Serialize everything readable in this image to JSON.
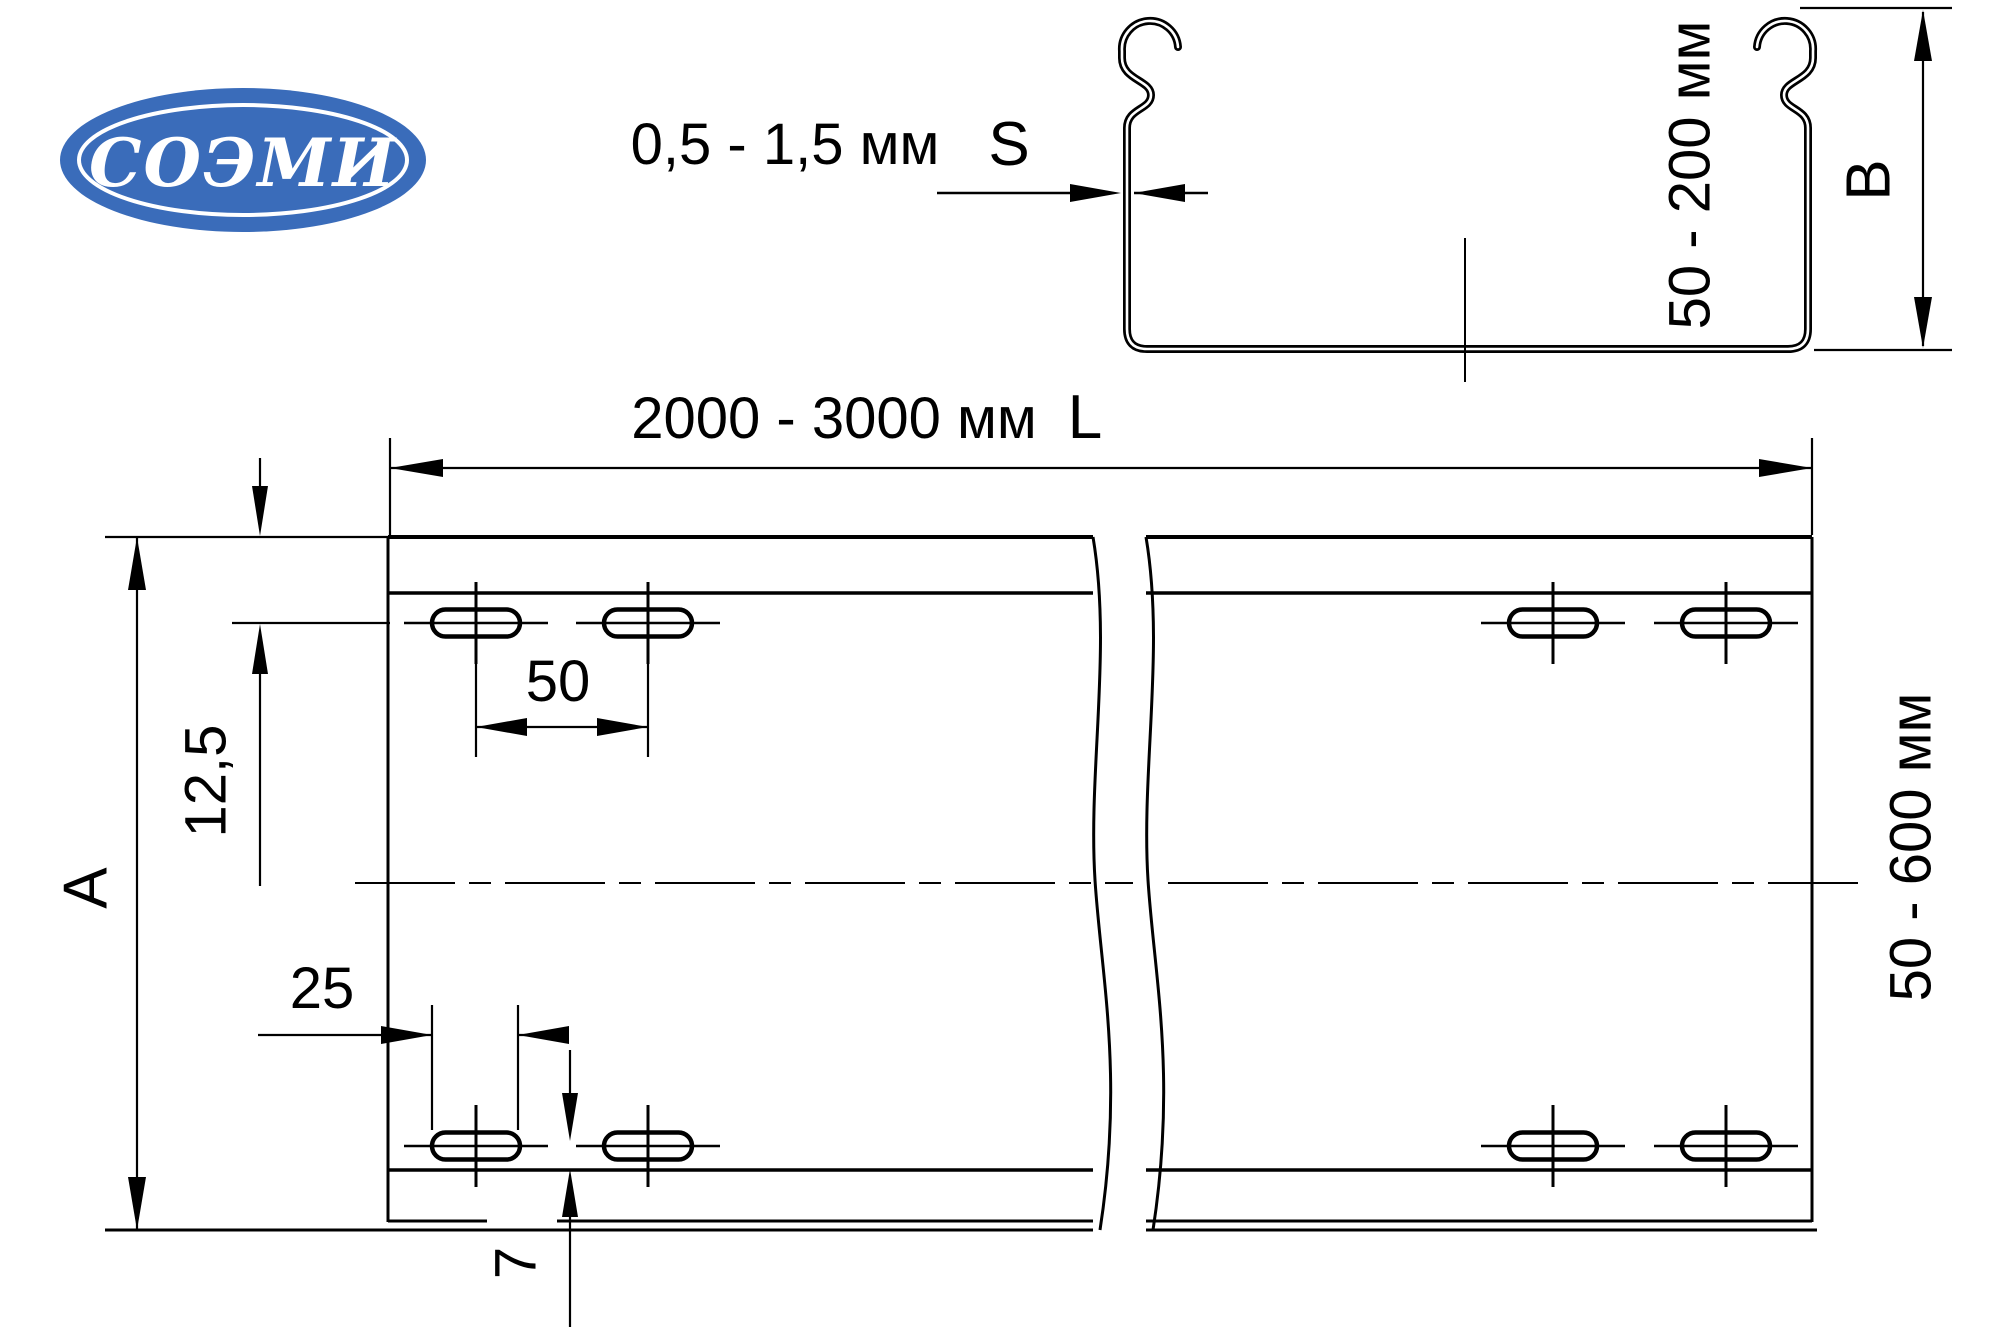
{
  "logo": {
    "text": "СОЭМИ"
  },
  "annotations": {
    "thickness": {
      "range": "0,5 - 1,5 мм",
      "symbol": "S"
    },
    "profile_height": {
      "range": "50 - 200 мм",
      "symbol": "B"
    },
    "length": {
      "range": "2000 - 3000 мм",
      "symbol": "L"
    },
    "width": {
      "range": "50 - 600 мм",
      "symbol": "A"
    },
    "hole_pitch": "50",
    "slot_length": "25",
    "edge_to_hole_row": "12,5",
    "hole_row_to_bend": "7"
  },
  "colors": {
    "line": "#000000",
    "logo_blue": "#3a6cba",
    "background": "#ffffff"
  }
}
